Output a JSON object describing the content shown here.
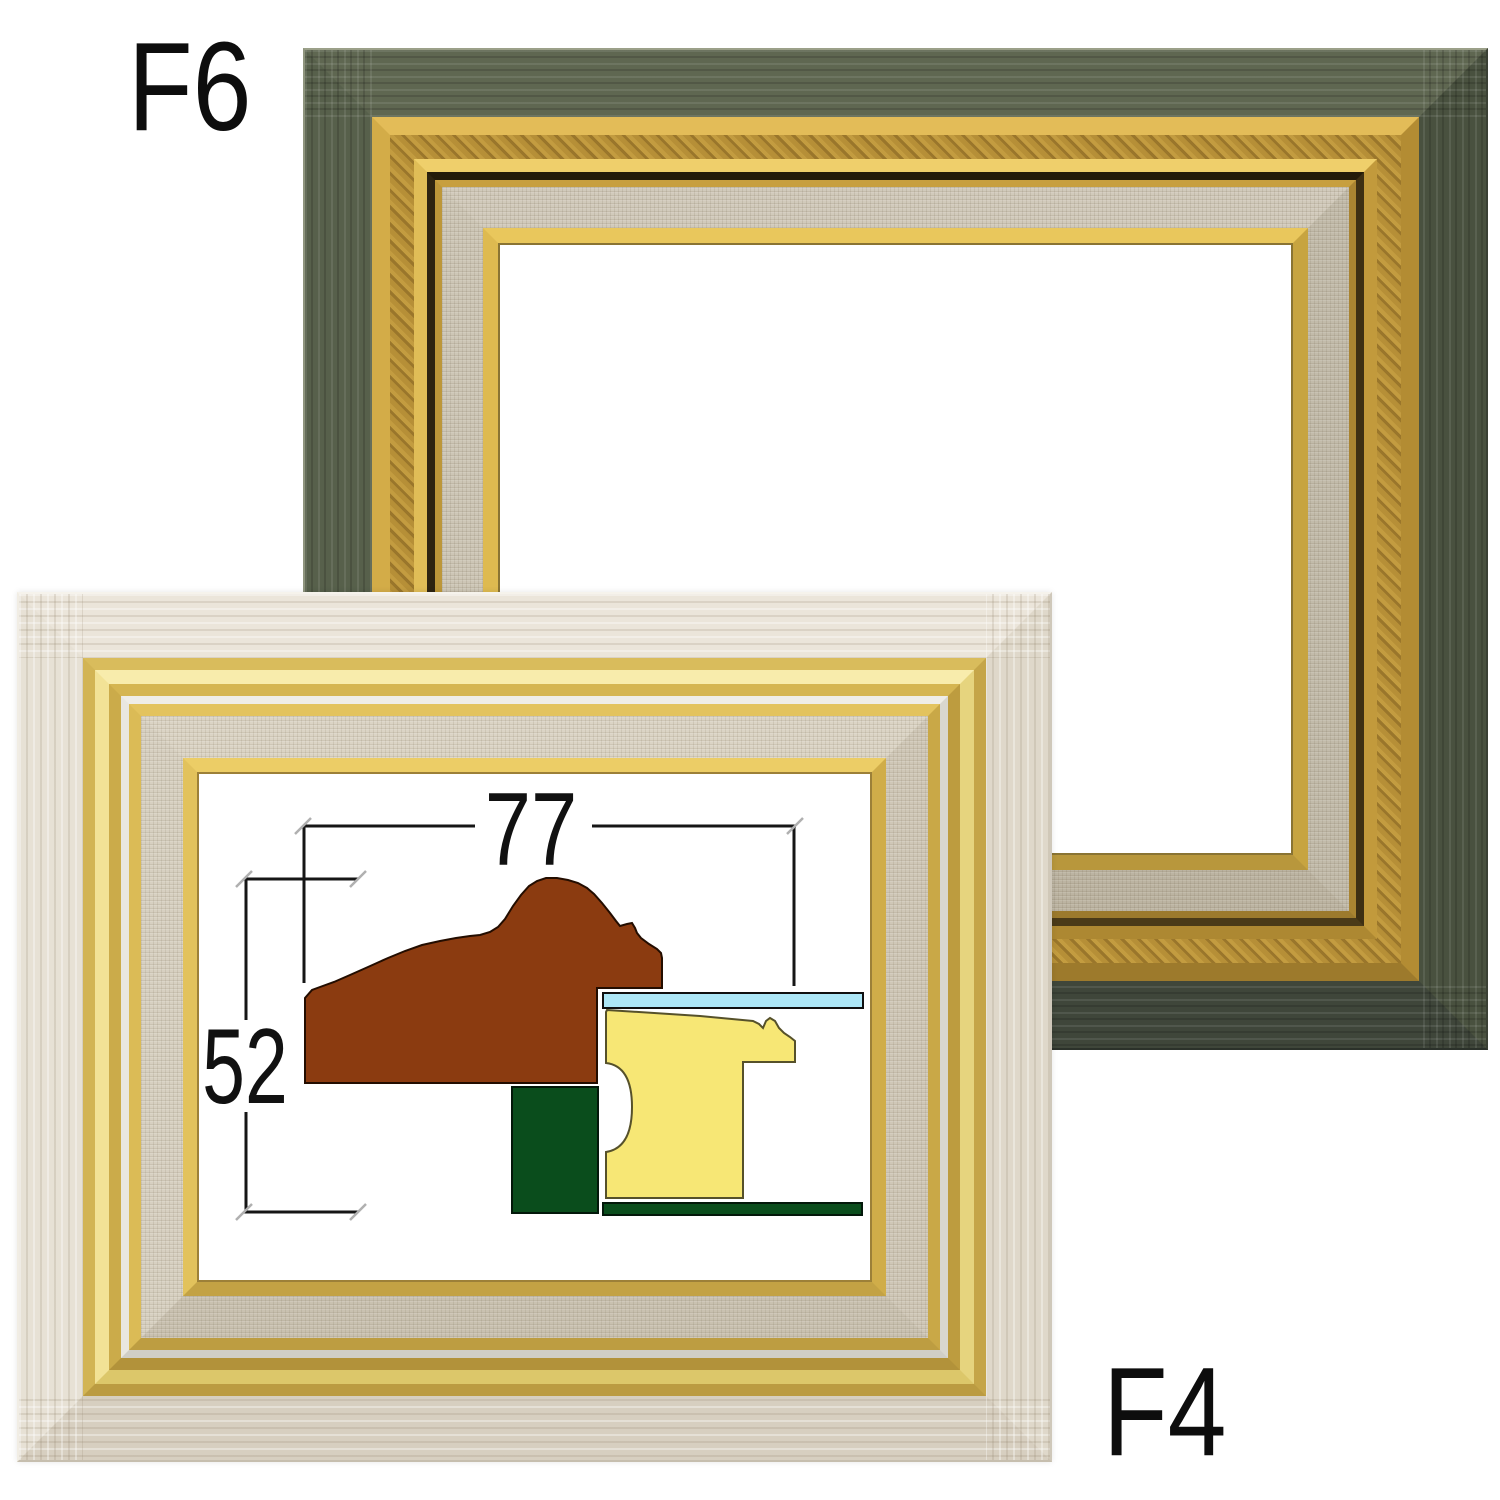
{
  "page": {
    "background": "#ffffff"
  },
  "labels": {
    "top_frame": "F6",
    "bottom_frame": "F4"
  },
  "frames": {
    "f6": {
      "label": "F6",
      "style": "dark green-grey wood frame with antique gold bands, linen liner and gold lip",
      "wood_color": "#5a6150",
      "gold_color": "#c59c40",
      "linen_color": "#cdc6b6",
      "interior_color": "#ffffff"
    },
    "f4": {
      "label": "F4",
      "style": "whitewashed wood frame with bright gold bands, silver stripe, linen liner and gold lip",
      "wood_color": "#e9e3d8",
      "gold_color": "#e2c25c",
      "silver_color": "#e9e7e0",
      "linen_color": "#d7d0c1",
      "interior_color": "#ffffff"
    }
  },
  "diagram": {
    "title": "moulding cross-section with dimensions",
    "width_value": "77",
    "height_value": "52",
    "line_color": "#161616",
    "tick_color": "#b0b0b0",
    "text_color": "#111111",
    "glass": {
      "x": 603,
      "y": 993,
      "w": 260,
      "h": 15,
      "fill": "#ade7f7",
      "stroke": "#101010"
    },
    "outer_moulding": {
      "fill": "#8b3b10",
      "stroke": "#230d00",
      "points": "305,1083 305,998 312,990 320,987 334,982 350,975 368,967 388,958 405,951 422,945 440,941 456,938 470,936 480,935 490,932 498,927 505,919 513,906 521,895 529,886 537,881 546,878 557,878 568,880 578,883 587,888 594,894 602,903 610,913 616,921 620,926 627,924 632,923 635,928 637,933 641,938 649,944 657,949 661,953 662,958 662,988 597,988 597,1083"
    },
    "inner_moulding": {
      "fill": "#f7e775",
      "stroke": "#56512a",
      "path": "M 607,1010 L 700,1016 L 753,1021 L 759,1024 L 763,1028 L 766,1021 L 770,1018 L 775,1021 L 779,1028 L 784,1033 L 790,1037 L 795,1041 L 795,1062 L 743,1062 L 743,1198 L 606,1198 L 606,1152 Q 632,1148 632,1107 Q 632,1066 606,1063 L 606,1012 Z"
    },
    "stretcher_bar": {
      "x": 512,
      "y": 1087,
      "w": 86,
      "h": 126,
      "fill": "#0a4d1c",
      "stroke": "#03180a"
    },
    "backing_strip": {
      "x": 603,
      "y": 1203,
      "w": 259,
      "h": 12,
      "fill": "#0a4d1c",
      "stroke": "#03180a"
    },
    "dim_lines": [
      [
        303,
        826,
        475,
        826
      ],
      [
        592,
        826,
        796,
        826
      ],
      [
        304,
        825,
        304,
        983
      ],
      [
        794,
        825,
        794,
        986
      ],
      [
        244,
        879,
        358,
        879
      ],
      [
        246,
        880,
        246,
        1020
      ],
      [
        246,
        1112,
        246,
        1211
      ],
      [
        244,
        1212,
        358,
        1212
      ]
    ],
    "ticks": [
      [
        303,
        826
      ],
      [
        795,
        826
      ],
      [
        244,
        879
      ],
      [
        358,
        879
      ],
      [
        244,
        1212
      ],
      [
        358,
        1212
      ]
    ],
    "texts": [
      {
        "label": "77",
        "x": 531,
        "y": 865,
        "size": 104,
        "sx": 0.8
      },
      {
        "label": "52",
        "x": 245,
        "y": 1103,
        "size": 107,
        "sx": 0.72
      }
    ]
  }
}
